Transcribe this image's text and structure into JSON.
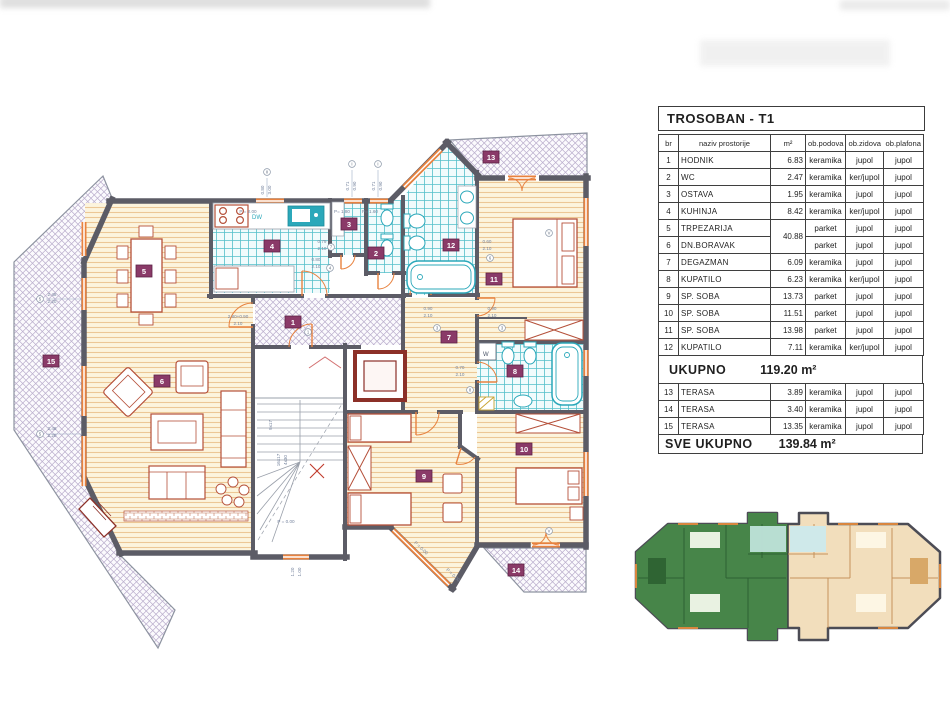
{
  "table": {
    "title": "TROSOBAN - T1",
    "columns": [
      "br",
      "naziv  prostorije",
      "m²",
      "ob.podova",
      "ob.zidova",
      "ob.plafona"
    ],
    "rows": [
      {
        "br": "1",
        "name": "HODNIK",
        "area": "6.83",
        "floor": "keramika",
        "walls": "jupol",
        "ceiling": "jupol"
      },
      {
        "br": "2",
        "name": "WC",
        "area": "2.47",
        "floor": "keramika",
        "walls": "ker/jupol",
        "ceiling": "jupol"
      },
      {
        "br": "3",
        "name": "OSTAVA",
        "area": "1.95",
        "floor": "keramika",
        "walls": "jupol",
        "ceiling": "jupol"
      },
      {
        "br": "4",
        "name": "KUHINJA",
        "area": "8.42",
        "floor": "keramika",
        "walls": "ker/jupol",
        "ceiling": "jupol"
      },
      {
        "br": "5",
        "name": "TRPEZARIJA",
        "area": "40.88",
        "area_span": 2,
        "floor": "parket",
        "walls": "jupol",
        "ceiling": "jupol"
      },
      {
        "br": "6",
        "name": "DN.BORAVAK",
        "area": null,
        "floor": "parket",
        "walls": "jupol",
        "ceiling": "jupol"
      },
      {
        "br": "7",
        "name": "DEGAZMAN",
        "area": "6.09",
        "floor": "keramika",
        "walls": "jupol",
        "ceiling": "jupol"
      },
      {
        "br": "8",
        "name": "KUPATILO",
        "area": "6.23",
        "floor": "keramika",
        "walls": "ker/jupol",
        "ceiling": "jupol"
      },
      {
        "br": "9",
        "name": "SP. SOBA",
        "area": "13.73",
        "floor": "parket",
        "walls": "jupol",
        "ceiling": "jupol"
      },
      {
        "br": "10",
        "name": "SP. SOBA",
        "area": "11.51",
        "floor": "parket",
        "walls": "jupol",
        "ceiling": "jupol"
      },
      {
        "br": "11",
        "name": "SP. SOBA",
        "area": "13.98",
        "floor": "parket",
        "walls": "jupol",
        "ceiling": "jupol"
      },
      {
        "br": "12",
        "name": "KUPATILO",
        "area": "7.11",
        "floor": "keramika",
        "walls": "ker/jupol",
        "ceiling": "jupol"
      }
    ],
    "subtotal": {
      "label": "UKUPNO",
      "value": "119.20 m²"
    },
    "terrace_rows": [
      {
        "br": "13",
        "name": "TERASA",
        "area": "3.89",
        "floor": "keramika",
        "walls": "jupol",
        "ceiling": "jupol"
      },
      {
        "br": "14",
        "name": "TERASA",
        "area": "3.40",
        "floor": "keramika",
        "walls": "jupol",
        "ceiling": "jupol"
      },
      {
        "br": "15",
        "name": "TERASA",
        "area": "13.35",
        "floor": "keramika",
        "walls": "jupol",
        "ceiling": "jupol"
      }
    ],
    "total": {
      "label": "SVE  UKUPNO",
      "value": "139.84 m²"
    }
  },
  "plan": {
    "room_badges": [
      {
        "n": "1",
        "x": 293,
        "y": 322
      },
      {
        "n": "2",
        "x": 376,
        "y": 253
      },
      {
        "n": "3",
        "x": 349,
        "y": 224
      },
      {
        "n": "4",
        "x": 272,
        "y": 246
      },
      {
        "n": "5",
        "x": 144,
        "y": 271
      },
      {
        "n": "6",
        "x": 162,
        "y": 381
      },
      {
        "n": "7",
        "x": 449,
        "y": 337
      },
      {
        "n": "8",
        "x": 515,
        "y": 371
      },
      {
        "n": "9",
        "x": 424,
        "y": 476
      },
      {
        "n": "10",
        "x": 524,
        "y": 449
      },
      {
        "n": "11",
        "x": 494,
        "y": 279
      },
      {
        "n": "12",
        "x": 451,
        "y": 245
      },
      {
        "n": "13",
        "x": 491,
        "y": 157
      },
      {
        "n": "14",
        "x": 516,
        "y": 570
      },
      {
        "n": "15",
        "x": 51,
        "y": 361
      }
    ],
    "annotations": [
      {
        "t": "2.48",
        "x": 52,
        "y": 296
      },
      {
        "t": "2.20",
        "x": 52,
        "y": 303
      },
      {
        "t": "2.48",
        "x": 52,
        "y": 430
      },
      {
        "t": "2.20",
        "x": 52,
        "y": 437
      },
      {
        "t": "P = 0.00",
        "x": 286,
        "y": 523
      },
      {
        "t": "P = 0.00",
        "x": 420,
        "y": 549,
        "r": 43
      },
      {
        "t": "P = 0.00",
        "x": 452,
        "y": 576,
        "r": 43
      },
      {
        "t": "P = 2.00",
        "x": 248,
        "y": 213
      },
      {
        "t": "P= 1.80",
        "x": 342,
        "y": 213
      },
      {
        "t": "P= 1.60",
        "x": 370,
        "y": 213
      },
      {
        "t": "0.90",
        "x": 428,
        "y": 310
      },
      {
        "t": "2.10",
        "x": 428,
        "y": 317
      },
      {
        "t": "0.90",
        "x": 492,
        "y": 310
      },
      {
        "t": "2.10",
        "x": 492,
        "y": 317
      },
      {
        "t": "0.60",
        "x": 487,
        "y": 243
      },
      {
        "t": "2.10",
        "x": 487,
        "y": 250
      },
      {
        "t": "0.70",
        "x": 460,
        "y": 369
      },
      {
        "t": "2.10",
        "x": 460,
        "y": 376
      },
      {
        "t": "0.79",
        "x": 322,
        "y": 243
      },
      {
        "t": "2.10",
        "x": 322,
        "y": 250
      },
      {
        "t": "0.80",
        "x": 316,
        "y": 261
      },
      {
        "t": "2.10",
        "x": 316,
        "y": 268
      },
      {
        "t": "2.80+0.90",
        "x": 238,
        "y": 318
      },
      {
        "t": "2.10",
        "x": 238,
        "y": 325
      },
      {
        "t": "1.20",
        "x": 294,
        "y": 572,
        "r": -90
      },
      {
        "t": "1.00",
        "x": 301,
        "y": 572,
        "r": -90
      },
      {
        "t": "16x17",
        "x": 280,
        "y": 460,
        "r": -90
      },
      {
        "t": "4x30",
        "x": 287,
        "y": 460,
        "r": -90
      },
      {
        "t": "9x17",
        "x": 272,
        "y": 425,
        "r": -90
      },
      {
        "t": "0.71",
        "x": 349,
        "y": 186,
        "r": -90
      },
      {
        "t": "0.90",
        "x": 356,
        "y": 186,
        "r": -90
      },
      {
        "t": "0.71",
        "x": 375,
        "y": 186,
        "r": -90
      },
      {
        "t": "0.90",
        "x": 382,
        "y": 186,
        "r": -90
      },
      {
        "t": "0.80",
        "x": 264,
        "y": 190,
        "r": -90
      },
      {
        "t": "3.00",
        "x": 271,
        "y": 190,
        "r": -90
      }
    ],
    "window_tags": [
      {
        "t": "II",
        "x": 267,
        "y": 172
      },
      {
        "t": "I",
        "x": 352,
        "y": 164
      },
      {
        "t": "I",
        "x": 378,
        "y": 164
      },
      {
        "t": "V",
        "x": 549,
        "y": 233
      },
      {
        "t": "V",
        "x": 549,
        "y": 531
      },
      {
        "t": "5",
        "x": 40,
        "y": 299
      },
      {
        "t": "5",
        "x": 40,
        "y": 434
      },
      {
        "t": "3",
        "x": 437,
        "y": 328
      },
      {
        "t": "3",
        "x": 502,
        "y": 328
      },
      {
        "t": "1",
        "x": 308,
        "y": 332
      },
      {
        "t": "7",
        "x": 331,
        "y": 247
      },
      {
        "t": "4",
        "x": 330,
        "y": 268
      },
      {
        "t": "6",
        "x": 490,
        "y": 258
      },
      {
        "t": "8",
        "x": 470,
        "y": 390
      }
    ],
    "labels": {
      "dw": "DW",
      "washer": "W",
      "level_entry": "P = 0.00"
    }
  },
  "colors": {
    "badge": "#8a3a68",
    "wall": "#5c5c66",
    "window": "#e8823f",
    "door": "#e8823f",
    "tile_line": "#54bfca",
    "wood_line": "#ecc795",
    "hatch_line": "#b9adcc",
    "fixture": "#2ba8ba",
    "furniture": "#b5503a",
    "elevator": "#8c3028",
    "keyplan_left_unit": "#478549",
    "keyplan_right_unit": "#f2debc"
  }
}
